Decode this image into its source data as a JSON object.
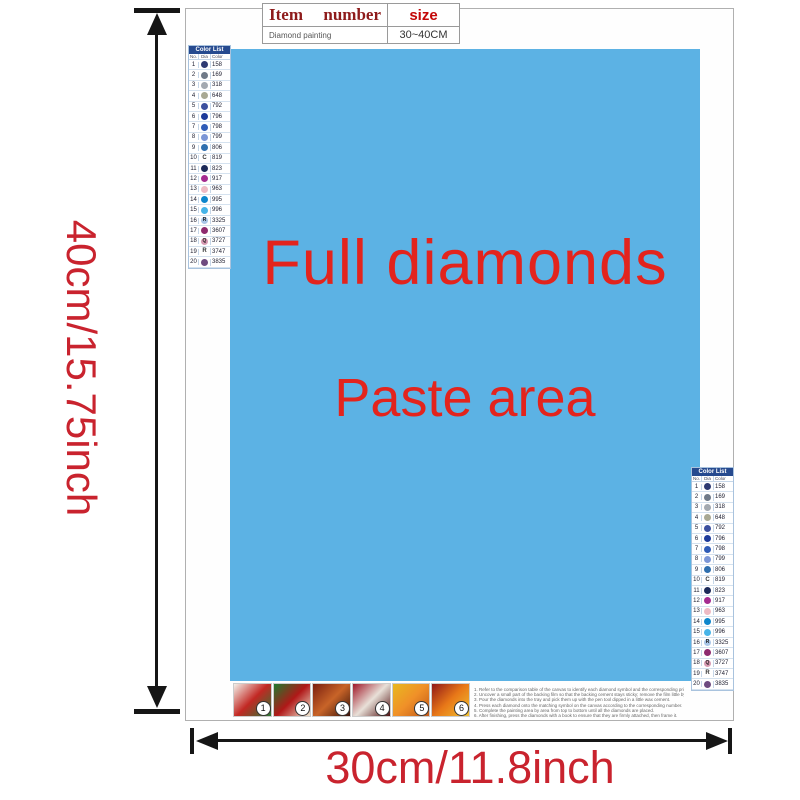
{
  "item_table": {
    "item_label": "Item",
    "number_label": "number",
    "size_label": "size",
    "product": "Diamond painting",
    "size_value": "30~40CM"
  },
  "paste_area": {
    "line1": "Full diamonds",
    "line2": "Paste area",
    "bg_color": "#5cb2e4",
    "text_color": "#e3241d"
  },
  "dimensions": {
    "height_label": "40cm/15.75inch",
    "width_label": "30cm/11.8inch",
    "label_color": "#c9232e"
  },
  "color_list": {
    "header": "Color List",
    "col_no": "No.",
    "col_diamond": "Dia",
    "col_color": "Color",
    "header_bg": "#264a8f",
    "rows": [
      {
        "no": "1",
        "code": "158",
        "icon": "#2e3a72"
      },
      {
        "no": "2",
        "code": "169",
        "icon": "#707a88"
      },
      {
        "no": "3",
        "code": "318",
        "icon": "#a3a9b0"
      },
      {
        "no": "4",
        "code": "648",
        "icon": "#a8a893"
      },
      {
        "no": "5",
        "code": "792",
        "icon": "#3c509f"
      },
      {
        "no": "6",
        "code": "796",
        "icon": "#1c3a9a"
      },
      {
        "no": "7",
        "code": "798",
        "icon": "#2f5cb7"
      },
      {
        "no": "8",
        "code": "799",
        "icon": "#7b96d6"
      },
      {
        "no": "9",
        "code": "806",
        "icon": "#2f6fae"
      },
      {
        "no": "10",
        "code": "819",
        "letter": "C"
      },
      {
        "no": "11",
        "code": "823",
        "icon": "#1d2a59"
      },
      {
        "no": "12",
        "code": "917",
        "icon": "#a52b90"
      },
      {
        "no": "13",
        "code": "963",
        "icon": "#eebac4"
      },
      {
        "no": "14",
        "code": "995",
        "icon": "#0d86cc"
      },
      {
        "no": "15",
        "code": "996",
        "icon": "#46b4e8"
      },
      {
        "no": "16",
        "code": "3325",
        "icon": "#a9c6e8",
        "letter": "R"
      },
      {
        "no": "17",
        "code": "3607",
        "icon": "#8e2a6e"
      },
      {
        "no": "18",
        "code": "3727",
        "icon": "#d79ab2",
        "letter": "Q"
      },
      {
        "no": "19",
        "code": "3747",
        "letter": "R"
      },
      {
        "no": "20",
        "code": "3835",
        "icon": "#6f4b80"
      }
    ]
  },
  "steps": {
    "items": [
      {
        "n": "1",
        "colors": [
          "#f3f1ea",
          "#c22823",
          "#2a7a35"
        ]
      },
      {
        "n": "2",
        "colors": [
          "#1e7a2e",
          "#b01818",
          "#efe6cf"
        ]
      },
      {
        "n": "3",
        "colors": [
          "#7a1f10",
          "#c86428",
          "#3a1208"
        ]
      },
      {
        "n": "4",
        "colors": [
          "#a01828",
          "#e8e0d8",
          "#501010"
        ]
      },
      {
        "n": "5",
        "colors": [
          "#e8b820",
          "#f09028",
          "#c05818"
        ]
      },
      {
        "n": "6",
        "colors": [
          "#901818",
          "#e87818",
          "#f0c030"
        ]
      }
    ],
    "instructions": [
      {
        "n": "1.",
        "text": "Refer to the comparison table of the canvas to identify each diamond symbol and the corresponding printed number on the canvas."
      },
      {
        "n": "2.",
        "text": "Uncover a small part of the backing film so that the backing cement stays sticky; remove the film little by little."
      },
      {
        "n": "3.",
        "text": "Pour the diamonds into the tray and pick them up with the pen tool dipped in a little wax cement."
      },
      {
        "n": "4.",
        "text": "Press each diamond onto the matching symbol on the canvas according to the corresponding number."
      },
      {
        "n": "5.",
        "text": "Complete the painting area by area from top to bottom until all the diamonds are placed."
      },
      {
        "n": "6.",
        "text": "After finishing, press the diamonds with a book to ensure that they are firmly attached, then frame it."
      }
    ]
  }
}
